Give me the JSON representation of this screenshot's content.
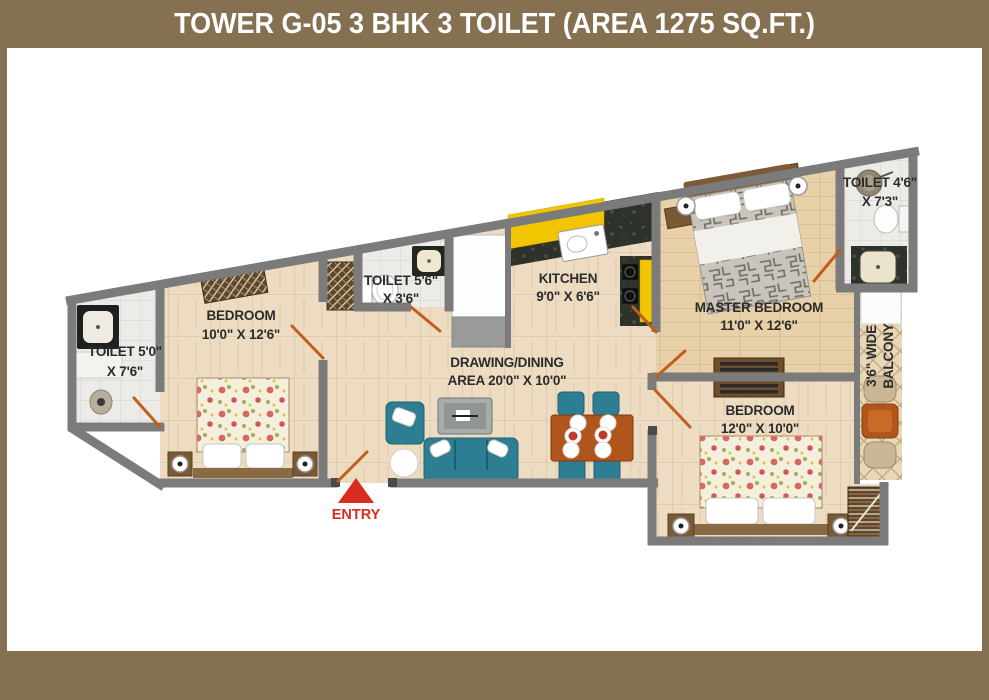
{
  "title": "TOWER G-05 3 BHK 3 TOILET (AREA 1275 SQ.FT.)",
  "entry": {
    "label": "ENTRY"
  },
  "rooms": {
    "toilet_left": {
      "line1": "TOILET 5'0\"",
      "line2": "X 7'6\""
    },
    "bedroom_left": {
      "line1": "BEDROOM",
      "line2": "10'0\" X 12'6\""
    },
    "toilet_mid": {
      "line1": "TOILET 5'6\"",
      "line2": "X 3'6\""
    },
    "kitchen": {
      "line1": "KITCHEN",
      "line2": "9'0\" X 6'6\""
    },
    "drawing_dining": {
      "line1": "DRAWING/DINING",
      "line2": "AREA 20'0\" X 10'0\""
    },
    "master_bedroom": {
      "line1": "MASTER BEDROOM",
      "line2": "11'0\" X 12'6\""
    },
    "toilet_right": {
      "line1": "TOILET 4'6\"",
      "line2": "X 7'3\""
    },
    "bedroom_right": {
      "line1": "BEDROOM",
      "line2": "12'0\" X 10'0\""
    },
    "balcony": {
      "line1": "3'6\" WIDE",
      "line2": "BALCONY"
    }
  },
  "colors": {
    "frame": "#857052",
    "titletext": "#ffffff",
    "wall": "#7b7b7b",
    "label": "#2b2b2b",
    "door": "#bf5f1e",
    "entry": "#d92b20",
    "yellow": "#f2c500",
    "teal": "#2d7d93",
    "wood": "#b0561d"
  }
}
